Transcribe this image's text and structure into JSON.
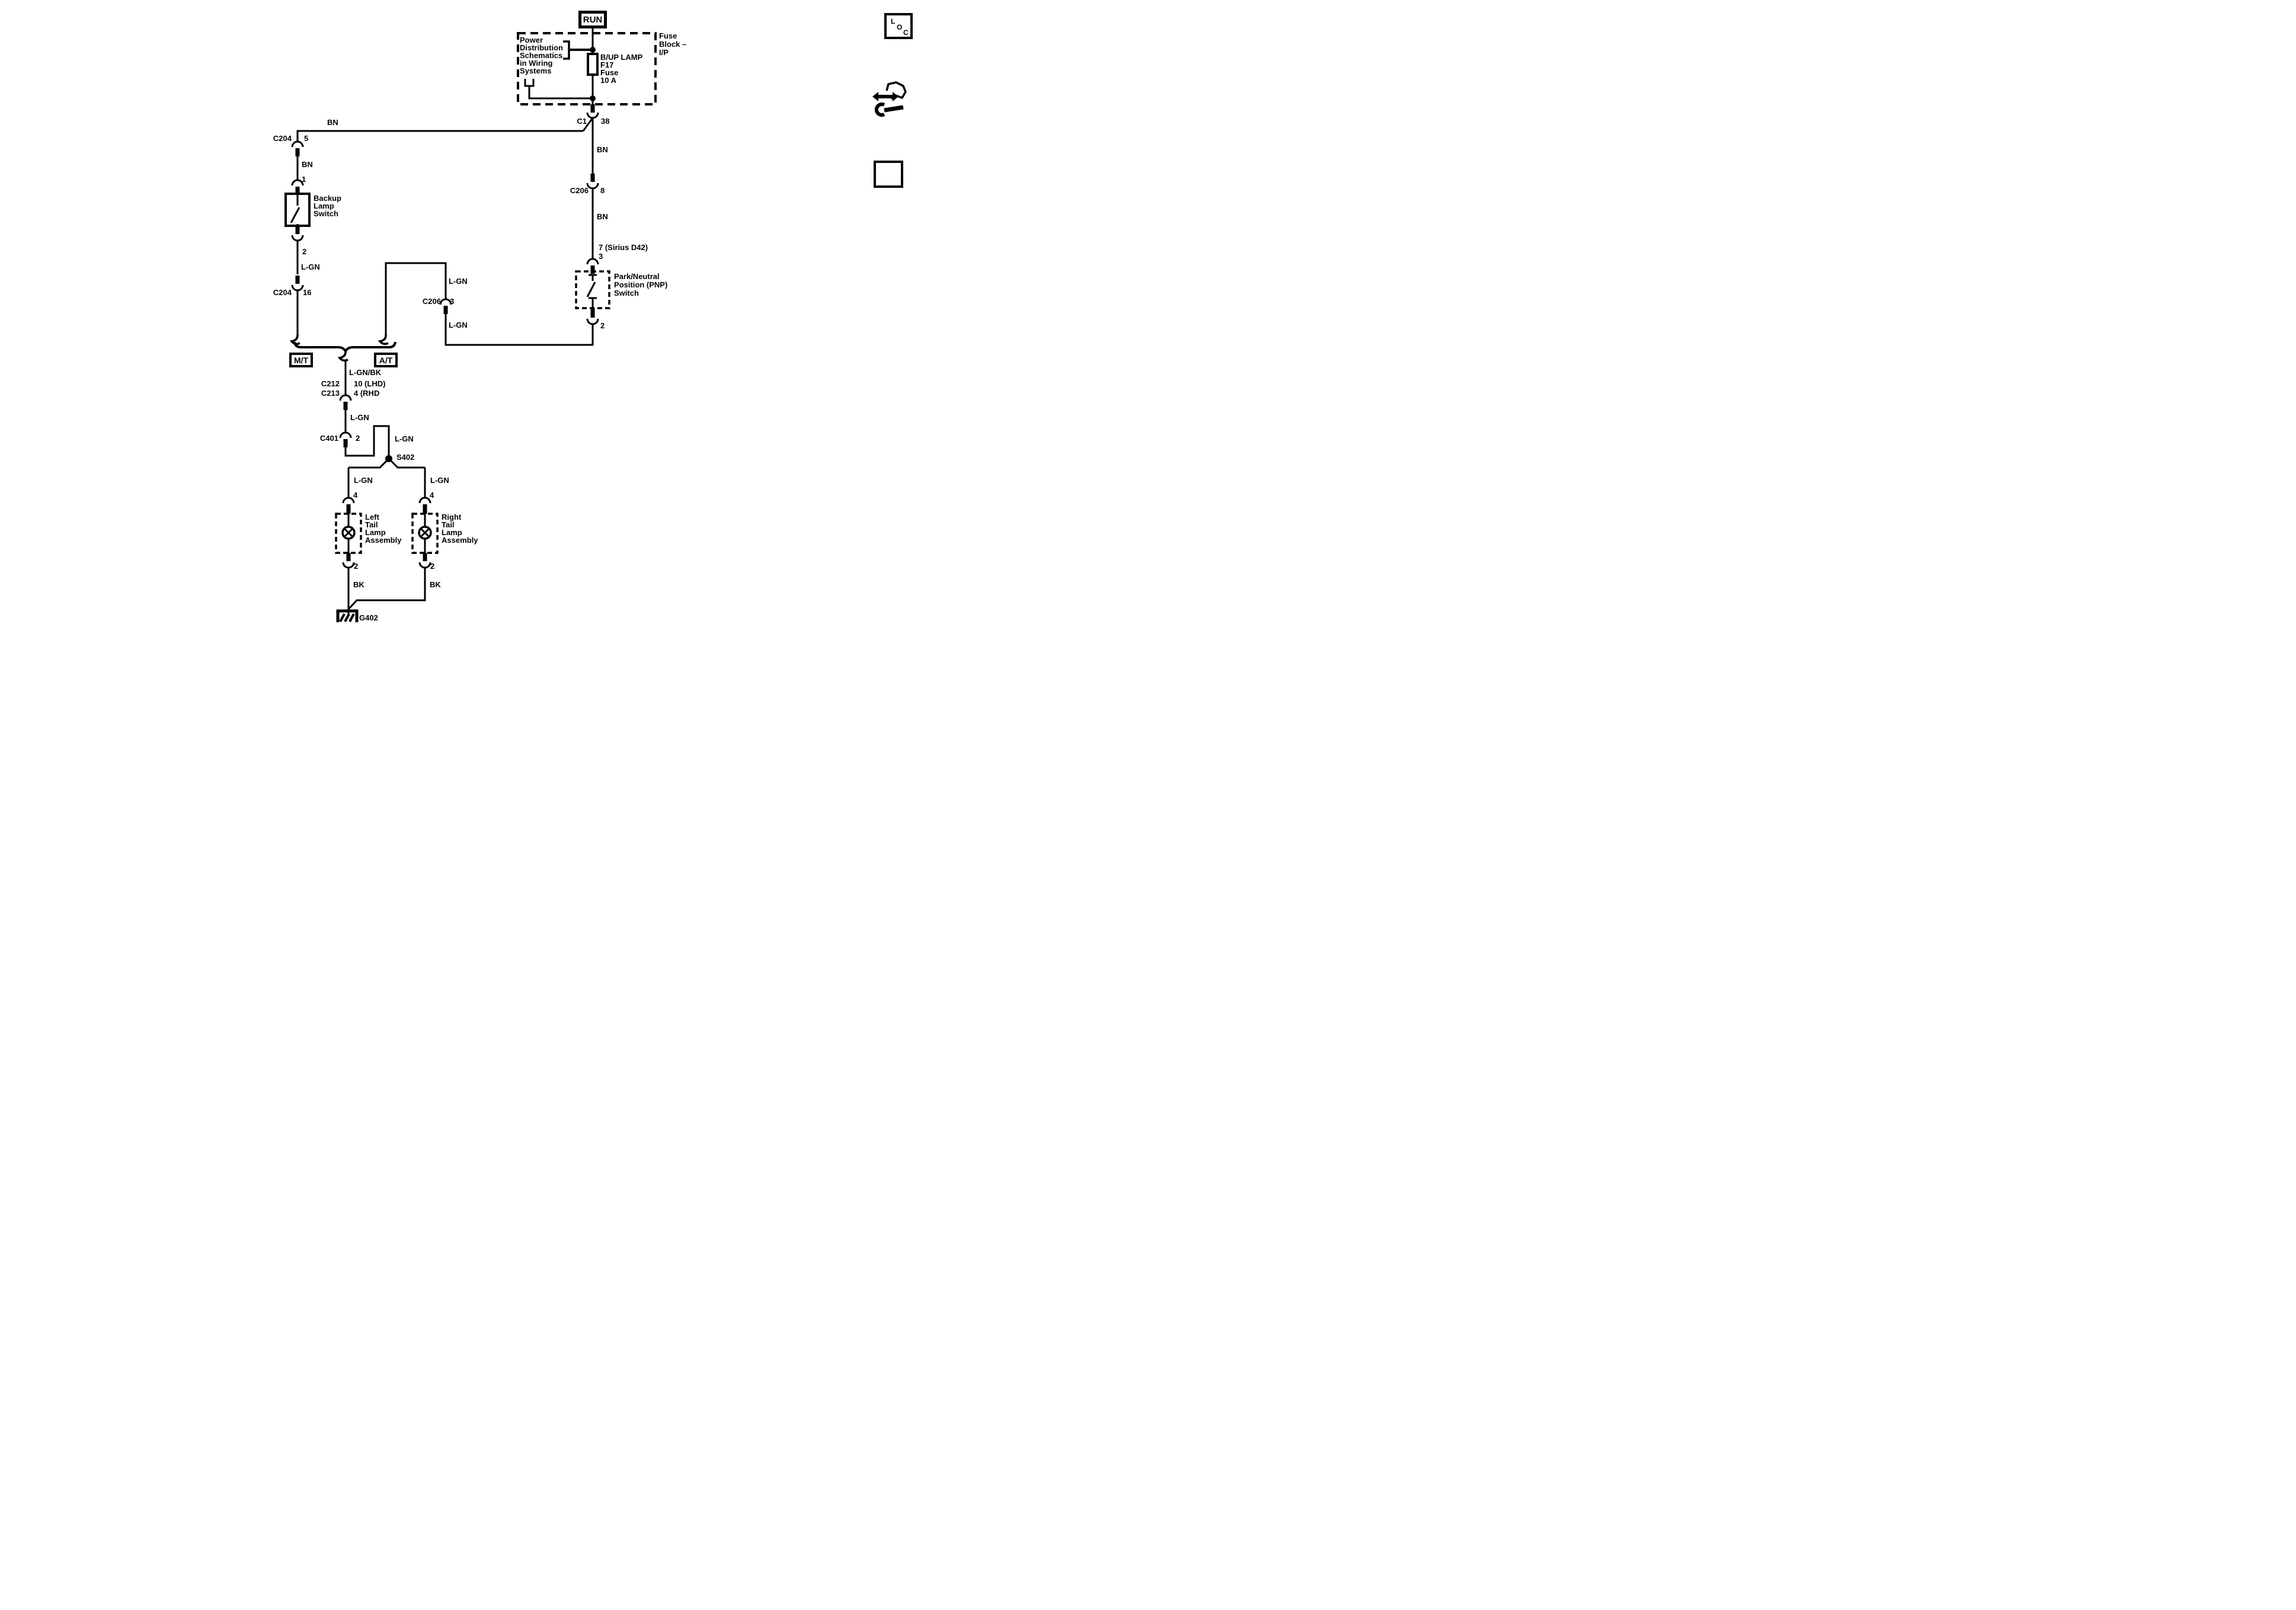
{
  "icons": {
    "loc_letters": [
      "L",
      "O",
      "C"
    ]
  },
  "power_mode": {
    "run": "RUN"
  },
  "fuse_block": {
    "block_title": [
      "Fuse",
      "Block –",
      "I/P"
    ],
    "ref_note": [
      "Power",
      "Distribution",
      "Schematics",
      "in Wiring",
      "Systems"
    ],
    "fuse_label": [
      "B/UP LAMP",
      "F17",
      "Fuse",
      "10 A"
    ]
  },
  "connectors": {
    "c1": {
      "name": "C1",
      "pin": "38"
    },
    "c204_top": {
      "name": "C204",
      "pin": "5"
    },
    "switch_pin_in": "1",
    "switch_pin_out": "2",
    "c204_bottom": {
      "name": "C204",
      "pin": "16"
    },
    "c206_right": {
      "name": "C206",
      "pin": "8"
    },
    "pnp_pin_in_alt": "7 (Sirius D42)",
    "pnp_pin_in": "3",
    "pnp_pin_out": "2",
    "c206_left": {
      "name": "C206",
      "pin": "3"
    },
    "c212": "C212",
    "c213": "C213",
    "c212_pin": "10 (LHD)",
    "c213_pin": "4 (RHD",
    "c401": {
      "name": "C401",
      "pin": "2"
    },
    "s402": "S402",
    "lamp_left_pin_in": "4",
    "lamp_left_pin_out": "2",
    "lamp_right_pin_in": "4",
    "lamp_right_pin_out": "2",
    "ground": "G402"
  },
  "wire_labels": {
    "bn_feed": "BN",
    "bn_branch": "BN",
    "bn_c1": "BN",
    "bn_c206": "BN",
    "lgn_switch": "L-GN",
    "lgn_at_upper": "L-GN",
    "lgn_at_lower": "L-GN",
    "lgnbk": "L-GN/BK",
    "lgn_center": "L-GN",
    "lgn_s402": "L-GN",
    "lgn_lamp_left": "L-GN",
    "lgn_lamp_right": "L-GN",
    "bk_left": "BK",
    "bk_right": "BK"
  },
  "components": {
    "backup_switch": [
      "Backup",
      "Lamp",
      "Switch"
    ],
    "pnp_switch": [
      "Park/Neutral",
      "Position (PNP)",
      "Switch"
    ],
    "left_lamp": [
      "Left",
      "Tail",
      "Lamp",
      "Assembly"
    ],
    "right_lamp": [
      "Right",
      "Tail",
      "Lamp",
      "Assembly"
    ],
    "mt": "M/T",
    "at": "A/T"
  }
}
